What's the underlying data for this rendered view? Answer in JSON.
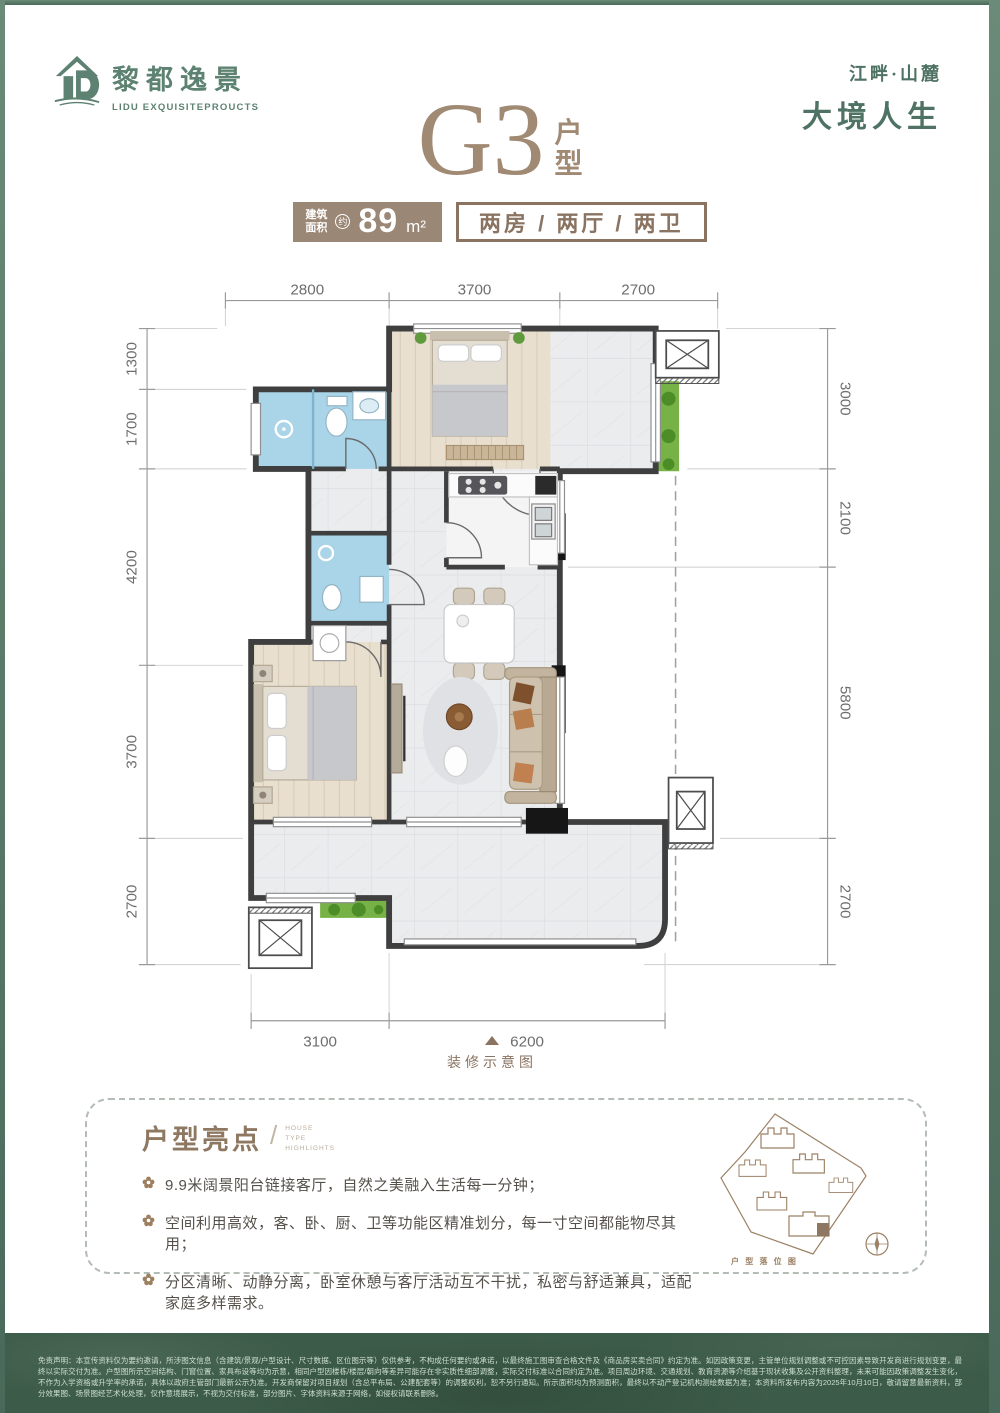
{
  "brand": {
    "logo_cn": "黎都逸景",
    "logo_en": "LIDU EXQUISITEPROUCTS",
    "slogan_line1": "江畔·山麓",
    "slogan_line2": "大境人生"
  },
  "title": {
    "code": "G3",
    "suffix_1": "户",
    "suffix_2": "型",
    "area_label_1": "建筑",
    "area_label_2": "面积",
    "area_approx": "约",
    "area_value": "89",
    "area_unit": "m²",
    "layout": "两房 / 两厅 / 两卫"
  },
  "plan": {
    "caption": "装修示意图",
    "dims_top": [
      "2800",
      "3700",
      "2700"
    ],
    "dims_left": [
      "1300",
      "1700",
      "4200",
      "3700",
      "2700"
    ],
    "dims_right": [
      "3000",
      "2100",
      "5800",
      "2700"
    ],
    "dims_bottom": [
      "3100",
      "6200"
    ]
  },
  "highlights": {
    "title": "户型亮点",
    "subtitle_line1": "HOUSE",
    "subtitle_line2": "TYPE",
    "subtitle_line3": "HIGHLIGHTS",
    "items": [
      "9.9米阔景阳台链接客厅，自然之美融入生活每一分钟；",
      "空间利用高效，客、卧、厨、卫等功能区精准划分，每一寸空间都能物尽其用；",
      "分区清晰、动静分离，卧室休憩与客厅活动互不干扰，私密与舒适兼具，适配家庭多样需求。"
    ]
  },
  "siteplan": {
    "label": "户 型 落 位 图"
  },
  "disclaimer": "免责声明：本宣传资料仅为要约邀请，所涉图文信息（含建筑/景观/户型设计、尺寸数据、区位图示等）仅供参考，不构成任何要约或承诺，以最终施工图审查合格文件及《商品房买卖合同》约定为准。如因政策变更，主管单位规划调整或不可控因素导致开发商进行规划变更，最终以实际交付为准。户型图所示空间结构、门窗位置、家具布设等均为示意，相同户型因楼栋/楼层/朝向等差异可能存在非实质性细部调整，实际交付标准以合同约定为准。项目周边环境、交通规划、教育资源等介绍基于现状收集及公开资料整理，未来可能因政策调整发生变化，不作为入学资格或升学率的承诺，具体以政府主管部门最新公示为准。开发商保留对项目规划（含总平布局、公建配套等）的调整权利，恕不另行通知。所示面积均为预测面积，最终以不动产登记机构测绘数据为准；本资料所发布内容为2025年10月10日，敬请留意最新资料，部分效果图、场景图经艺术化处理，仅作意境展示，不视为交付标准，部分图片、字体资料来源于网络，如侵权请联系删除。",
  "colors": {
    "brand_green": "#5d8272",
    "title_brown": "#9b8775",
    "bath_blue": "#aad4e8",
    "band_green": "#3c5b48"
  }
}
